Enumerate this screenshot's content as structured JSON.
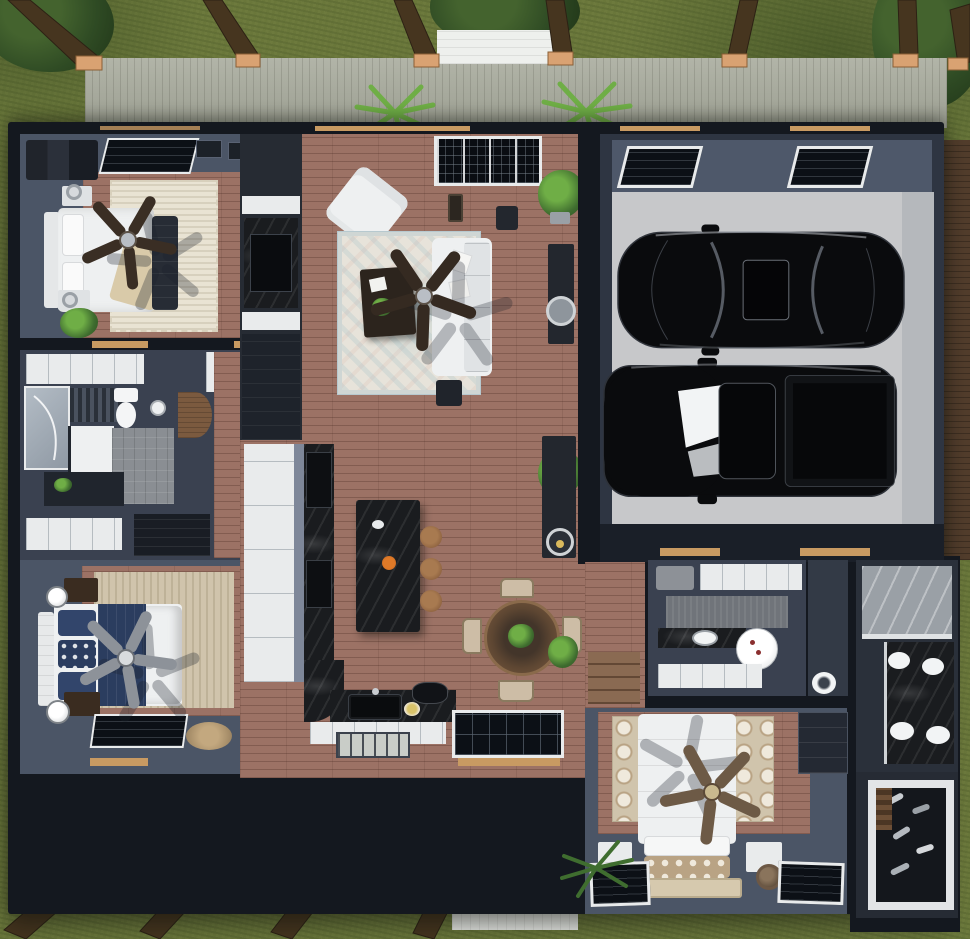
{
  "scene": {
    "title": "overhead-3d-floor-plan-render",
    "description": "Top-down doll-house render of a single-story home with wrap deck, two-car garage, living-kitchen core, three bedrooms and two baths",
    "no_visible_text": true
  },
  "palette": {
    "grass": "#6d7a3d",
    "foliage": "#2f4b24",
    "foliageLight": "#6fae46",
    "deck": "#a9ac9e",
    "sideDeckWood": "#523d2c",
    "post": "#46351f",
    "postLight": "#d9a272",
    "shell": "#14181f",
    "wallSlate": "#4b5566",
    "wallDark": "#3a4150",
    "wood": "#9c7265",
    "concrete": "#c7c8ca",
    "concreteWall": "#b5b8bc",
    "white": "#eef0f1",
    "frameWhite": "#e9ebec",
    "cream": "#e9e3d3",
    "rugTan": "#d0c4ac",
    "rugPattern": "#b9a384",
    "navy": "#2b3d5f",
    "marbleBlack": "#1a1c1f",
    "marbleGray": "#9aa0a6",
    "tile": "#8a8e93",
    "glass": "#0c1016",
    "stool": "#8a5f3e",
    "tableWood": "#7b5a3f",
    "accentOrange": "#e07a28",
    "lintel": "#c89a62",
    "carBlack": "#0a0b0d",
    "fanDark": "#3a2e24",
    "fanGray": "#8d9299",
    "fanBrown": "#6d5a46"
  },
  "exterior": {
    "items": [
      "grass-lawn",
      "shrubs",
      "upper-deck",
      "lower-deck",
      "white-stairs-top",
      "white-stairs-bottom",
      "pergola-posts",
      "deck-palms",
      "side-wood-deck"
    ]
  },
  "rooms": [
    {
      "name": "bedroom-front-left",
      "floor": "wood + cream shag rug",
      "furniture": [
        "white-bed",
        "tufted-bench",
        "nightstands",
        "ceiling-fan-dark",
        "potted-plant",
        "skylight-window"
      ]
    },
    {
      "name": "hall-bath-left",
      "floor": "gray tile",
      "furniture": [
        "glass-shower",
        "toilet",
        "white-vanity",
        "linen-shelves",
        "wood-door",
        "dark-counter"
      ]
    },
    {
      "name": "bedroom-back-left",
      "floor": "wood + tan rug",
      "furniture": [
        "bed-navy-white",
        "tufted-headboard",
        "nightstand-lamps",
        "ceiling-fan-gray",
        "floor-window",
        "round-jute-rug"
      ]
    },
    {
      "name": "living-room",
      "floor": "wood plank",
      "furniture": [
        "entry-door-glass",
        "white-armchair",
        "patterned-blue-rug",
        "dark-coffee-table",
        "white-sectional-sofa",
        "console-with-round-mirror",
        "fiddle-leaf-plant",
        "ceiling-fan-dark"
      ]
    },
    {
      "name": "kitchen",
      "floor": "wood plank",
      "furniture": [
        "black-marble-island",
        "three-wood-stools",
        "orange-flower-vase",
        "white-cabinet-run",
        "double-ovens",
        "black-sink",
        "cooktop",
        "round-dining-table",
        "four-cream-chairs",
        "grid-window"
      ]
    },
    {
      "name": "entry-hall",
      "floor": "wood plank",
      "furniture": [
        "console-table",
        "round-tray",
        "potted-plants",
        "wood-steps"
      ]
    },
    {
      "name": "garage",
      "floor": "concrete",
      "furniture": [
        "black-sedan",
        "black-pickup-truck",
        "two-skylight-windows"
      ]
    },
    {
      "name": "laundry-mudroom",
      "floor": "gray carpet",
      "furniture": [
        "white-cabinets",
        "utility-sink",
        "round-white-table",
        "charcoal-benches",
        "toilet-closet"
      ]
    },
    {
      "name": "master-bath",
      "floor": "black marble",
      "furniture": [
        "gray-marble-wall",
        "double-vanity-4-white-basins"
      ]
    },
    {
      "name": "walk-in-closet",
      "floor": "dark",
      "furniture": [
        "white-framed-shoe-wall",
        "shoe-shelves"
      ]
    },
    {
      "name": "master-bedroom",
      "floor": "wood + circle-pattern rug",
      "furniture": [
        "white-bed-tan-pillows",
        "white-nightstands",
        "round-lamps",
        "ceiling-fan-brown",
        "two-floor-windows",
        "dark-dresser",
        "palm-plant"
      ]
    }
  ],
  "vehicles": [
    {
      "name": "sedan",
      "color": "black",
      "feature": "sunroof"
    },
    {
      "name": "pickup-truck",
      "color": "black",
      "feature": "open-bed, bright windshield reflection"
    }
  ]
}
